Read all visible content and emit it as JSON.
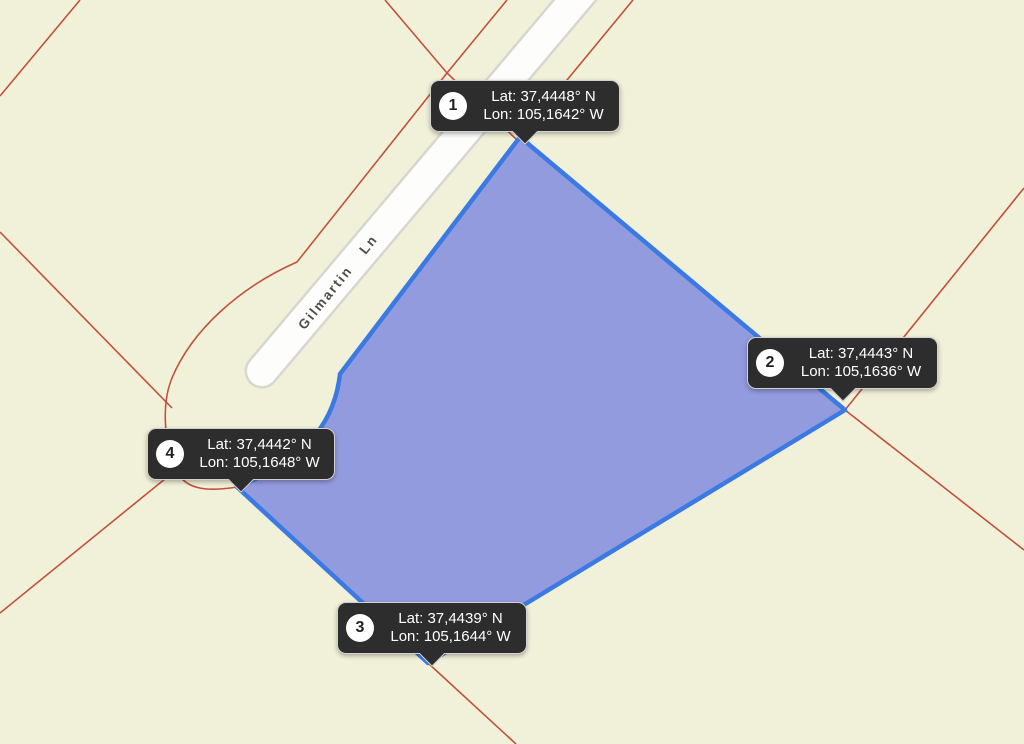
{
  "map": {
    "background_color": "#f1f0d9",
    "road": {
      "label": "Gilmartin Ln"
    },
    "parcel": {
      "fill_color": "#939bdf",
      "stroke_color": "#3b7ae2",
      "vertex_count": 4
    },
    "boundary_line_color": "#c0523d",
    "tooltip": {
      "background_color": "#2d2d2d",
      "text_color": "#ffffff"
    }
  },
  "markers": [
    {
      "number": "1",
      "lat_label": "Lat: 37,4448° N",
      "lon_label": "Lon: 105,1642° W"
    },
    {
      "number": "2",
      "lat_label": "Lat: 37,4443° N",
      "lon_label": "Lon: 105,1636° W"
    },
    {
      "number": "3",
      "lat_label": "Lat: 37,4439° N",
      "lon_label": "Lon: 105,1644° W"
    },
    {
      "number": "4",
      "lat_label": "Lat: 37,4442° N",
      "lon_label": "Lon: 105,1648° W"
    }
  ]
}
